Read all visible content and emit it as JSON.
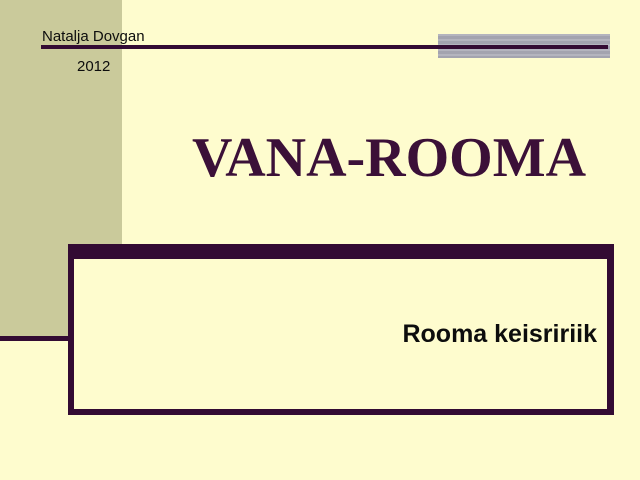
{
  "slide": {
    "author": "Natalja Dovgan",
    "year": "2012",
    "title": "VANA-ROOMA",
    "subtitle": "Rooma keisririik"
  },
  "colors": {
    "background": "#FEFCCE",
    "left_panel_olive": "#CACA9B",
    "accent_rule_plum": "#330B33",
    "title_text_plum": "#3B1038",
    "top_bar_gray": "#ABABB6",
    "body_text": "#0D0D0D"
  }
}
